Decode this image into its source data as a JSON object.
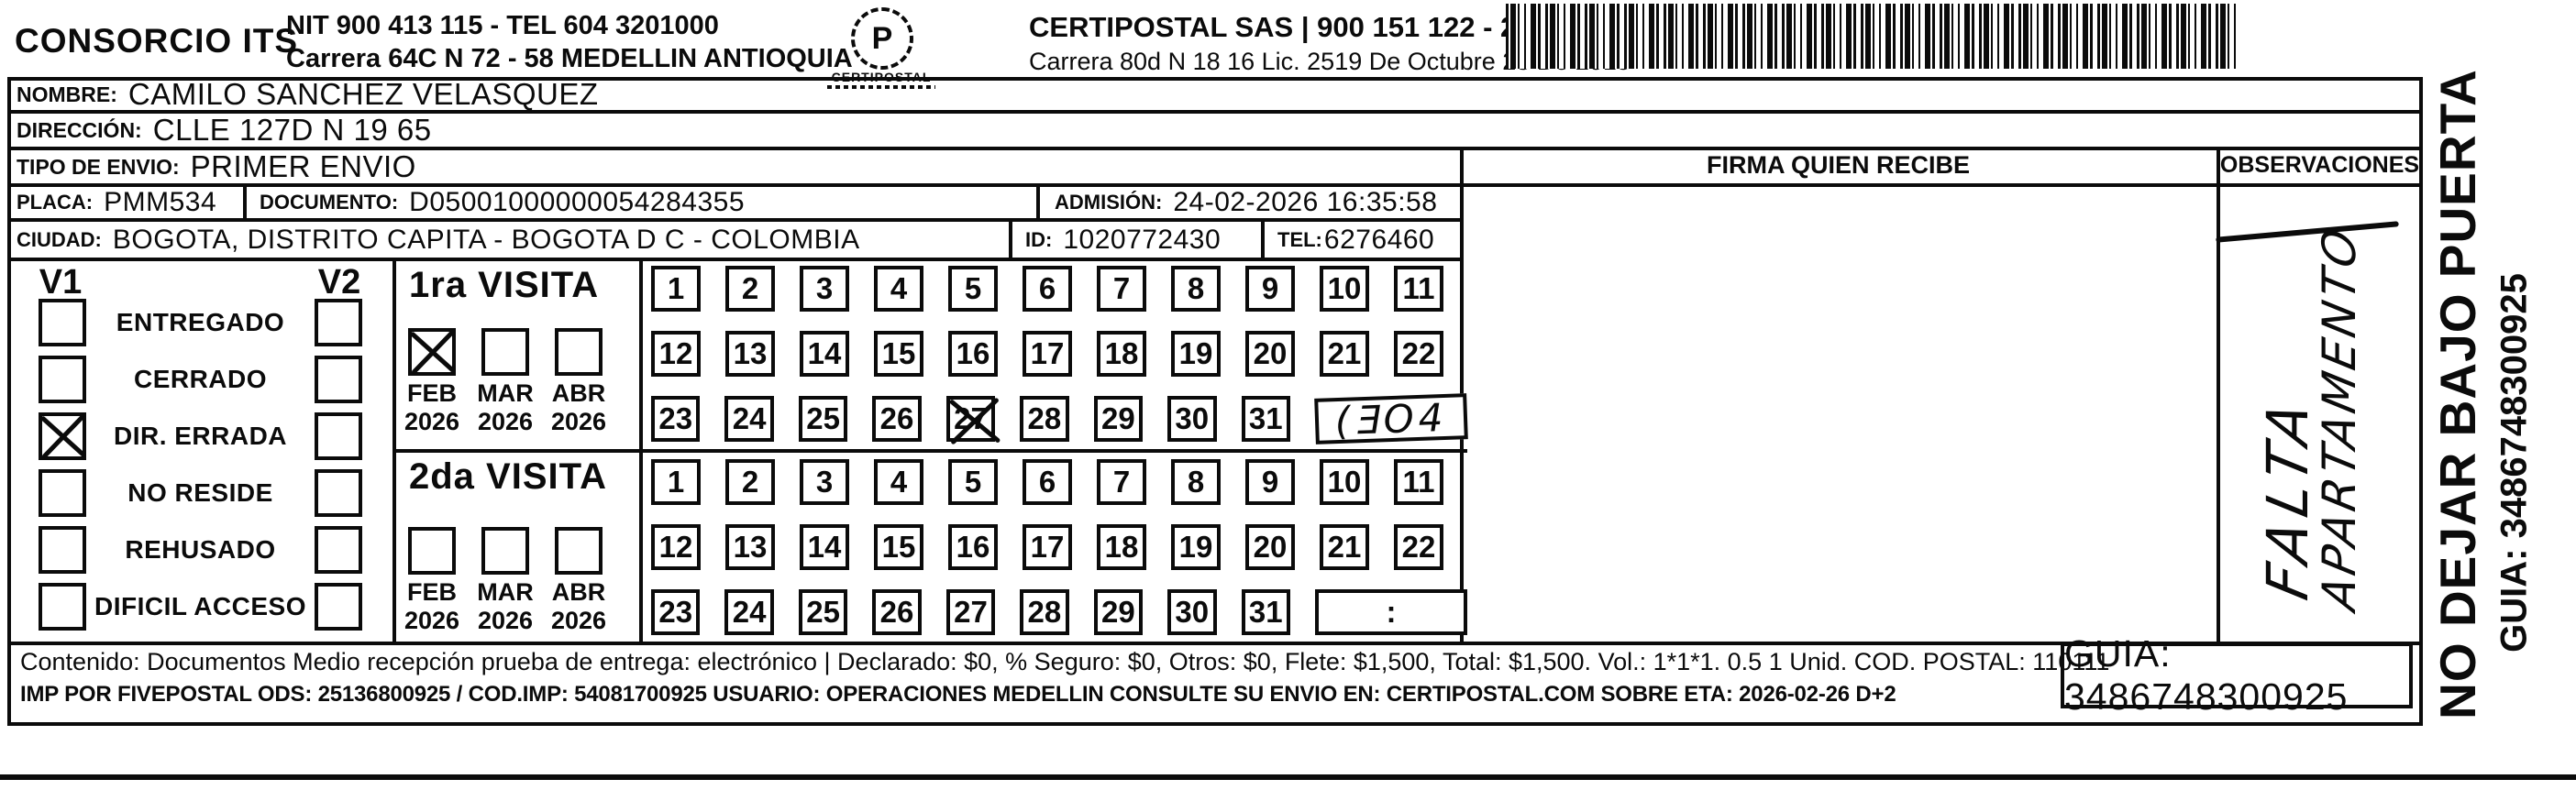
{
  "header": {
    "company": "CONSORCIO ITS",
    "nit_line": "NIT 900 413 115 - TEL 604 3201000",
    "address_line": "Carrera 64C N 72 - 58 MEDELLIN ANTIOQUIA",
    "logo_glyph": "P",
    "logo_text": "CERTIPOSTAL",
    "certipostal_line": "CERTIPOSTAL SAS | 900 151 122 - 2",
    "certipostal_address": "Carrera 80d N 18 16  Lic. 2519 De Octubre 23 De 2015"
  },
  "recipient": {
    "nombre_label": "NOMBRE:",
    "nombre": "CAMILO SANCHEZ VELASQUEZ",
    "direccion_label": "DIRECCIÓN:",
    "direccion": "CLLE 127D N 19 65",
    "tipo_label": "TIPO DE ENVIO:",
    "tipo": "PRIMER ENVIO",
    "placa_label": "PLACA:",
    "placa": "PMM534",
    "documento_label": "DOCUMENTO:",
    "documento": "D05001000000054284355",
    "admision_label": "ADMISIÓN:",
    "admision": "24-02-2026 16:35:58",
    "ciudad_label": "CIUDAD:",
    "ciudad": "BOGOTA, DISTRITO CAPITA - BOGOTA D C - COLOMBIA",
    "id_label": "ID:",
    "id": "1020772430",
    "tel_label": "TEL:",
    "tel": "6276460"
  },
  "firma": {
    "header": "FIRMA QUIEN RECIBE"
  },
  "observaciones": {
    "header": "OBSERVACIONES",
    "handwriting_line1": "FALTA",
    "handwriting_line2": "APARTAMENTO"
  },
  "status": {
    "v1_header": "V1",
    "v2_header": "V2",
    "rows": [
      {
        "label": "ENTREGADO",
        "v1": false,
        "v2": false
      },
      {
        "label": "CERRADO",
        "v1": false,
        "v2": false
      },
      {
        "label": "DIR. ERRADA",
        "v1": true,
        "v2": false
      },
      {
        "label": "NO RESIDE",
        "v1": false,
        "v2": false
      },
      {
        "label": "REHUSADO",
        "v1": false,
        "v2": false
      },
      {
        "label": "DIFICIL ACCESO",
        "v1": false,
        "v2": false
      }
    ]
  },
  "visits": [
    {
      "title": "1ra VISITA",
      "months": [
        {
          "month": "FEB",
          "year": "2026",
          "checked": true
        },
        {
          "month": "MAR",
          "year": "2026",
          "checked": false
        },
        {
          "month": "ABR",
          "year": "2026",
          "checked": false
        }
      ],
      "days": [
        [
          1,
          2,
          3,
          4,
          5,
          6,
          7,
          8,
          9,
          10,
          11
        ],
        [
          12,
          13,
          14,
          15,
          16,
          17,
          18,
          19,
          20,
          21,
          22
        ],
        [
          23,
          24,
          25,
          26,
          27,
          28,
          29,
          30,
          31
        ]
      ],
      "crossed_days": [
        27
      ],
      "extra_cell": "(ƎO4"
    },
    {
      "title": "2da VISITA",
      "months": [
        {
          "month": "FEB",
          "year": "2026",
          "checked": false
        },
        {
          "month": "MAR",
          "year": "2026",
          "checked": false
        },
        {
          "month": "ABR",
          "year": "2026",
          "checked": false
        }
      ],
      "days": [
        [
          1,
          2,
          3,
          4,
          5,
          6,
          7,
          8,
          9,
          10,
          11
        ],
        [
          12,
          13,
          14,
          15,
          16,
          17,
          18,
          19,
          20,
          21,
          22
        ],
        [
          23,
          24,
          25,
          26,
          27,
          28,
          29,
          30,
          31
        ]
      ],
      "crossed_days": [],
      "extra_cell": ":"
    }
  ],
  "footer": {
    "line1": "Contenido: Documentos Medio recepción prueba de entrega: electrónico | Declarado: $0, % Seguro: $0, Otros: $0, Flete: $1,500, Total: $1,500. Vol.: 1*1*1. 0.5  1 Unid. COD. POSTAL: 110111",
    "line2": "IMP POR FIVEPOSTAL ODS: 25136800925 / COD.IMP: 54081700925 USUARIO: OPERACIONES MEDELLIN CONSULTE SU ENVIO EN: CERTIPOSTAL.COM SOBRE ETA: 2026-02-26 D+2",
    "guia": "GUIA: 3486748300925"
  },
  "side": {
    "line1": "NO DEJAR BAJO PUERTA",
    "line2": "GUIA: 3486748300925"
  },
  "colors": {
    "ink": "#0b0b0b",
    "paper": "#ffffff"
  }
}
